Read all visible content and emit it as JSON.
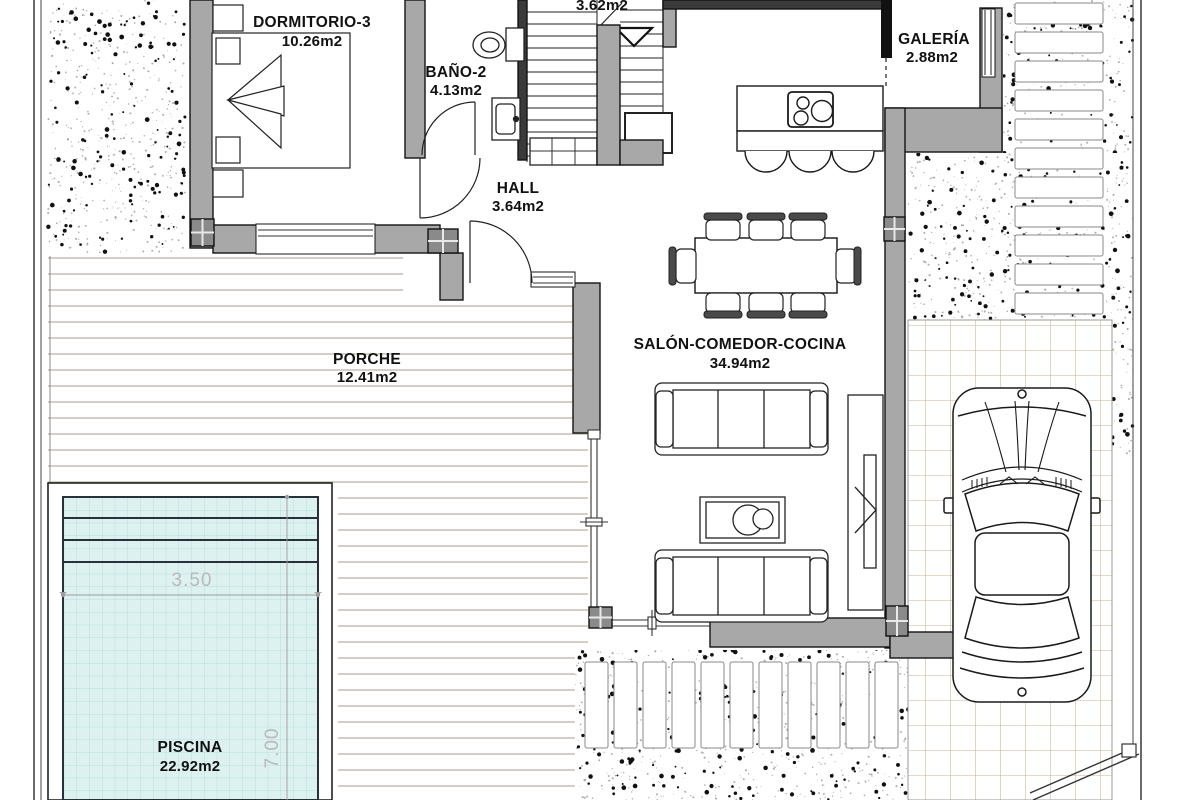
{
  "plan": {
    "rooms": {
      "dormitorio": {
        "name": "DORMITORIO-3",
        "area": "10.26m2"
      },
      "bano": {
        "name": "BAÑO-2",
        "area": "4.13m2"
      },
      "hall": {
        "name": "HALL",
        "area": "3.64m2"
      },
      "escalera": {
        "area": "3.62m2"
      },
      "galeria": {
        "name": "GALERÍA",
        "area": "2.88m2"
      },
      "salon": {
        "name": "SALÓN-COMEDOR-COCINA",
        "area": "34.94m2"
      },
      "porche": {
        "name": "PORCHE",
        "area": "12.41m2"
      },
      "piscina": {
        "name": "PISCINA",
        "area": "22.92m2"
      }
    },
    "pool_dimensions": {
      "width": "3.50",
      "length": "7.00"
    },
    "colors": {
      "wall": "#a8a8a8",
      "wall_stroke": "#141414",
      "pool_fill": "#def1f1",
      "pool_grid": "#b7e0e0",
      "tile_line": "#c9b190",
      "deck_line": "#a89f8c",
      "speckle_dark": "#111111",
      "speckle_light": "#9a9a9a"
    }
  }
}
